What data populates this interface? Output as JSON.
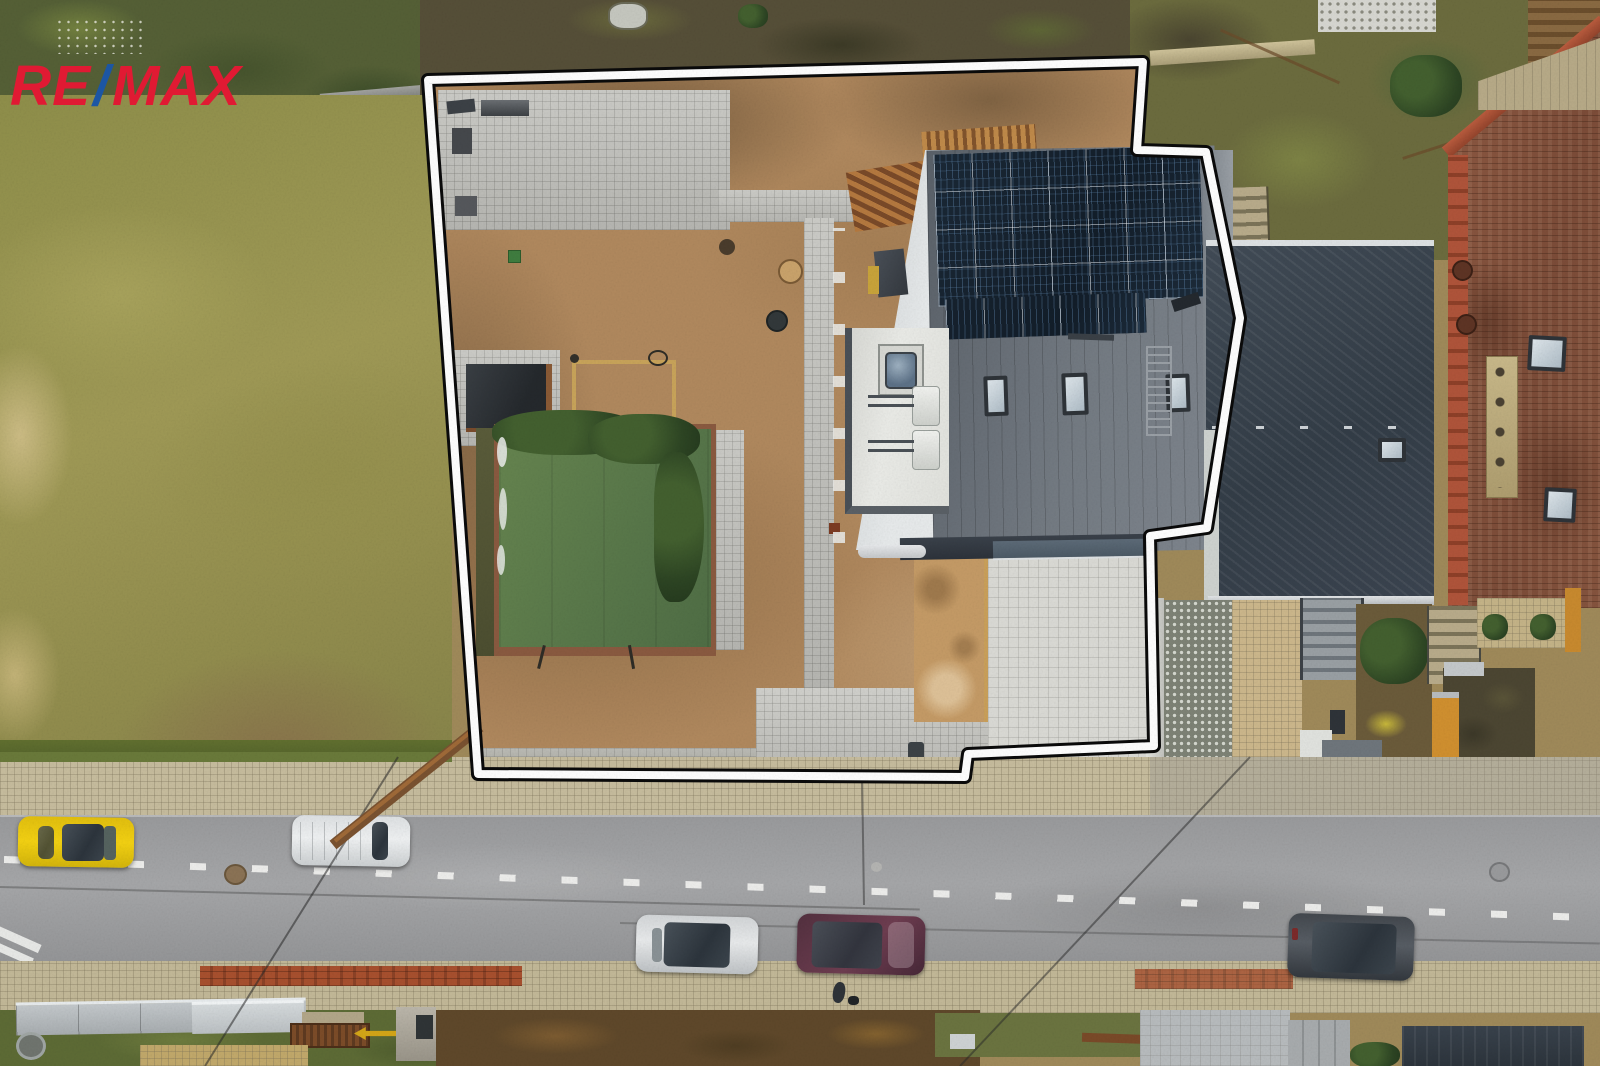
{
  "branding": {
    "logo_re": "RE",
    "logo_slash": "/",
    "logo_max": "MAX"
  },
  "palette": {
    "brand_red": "#e01a33",
    "brand_blue": "#1c56a4",
    "boundary_line_white": "#ffffff",
    "boundary_line_black": "#0a0a0a",
    "meadow_green": "#9c9850",
    "plot_sand": "#b28a5f",
    "paver_gray": "#c6c6c1",
    "driveway_light": "#dbdbd6",
    "house_roof_gray": "#6b727a",
    "solar_panel_navy": "#16222f",
    "flat_roof_white": "#e9eae6",
    "pool_cover_green": "#5d7c4b",
    "neighbor_roof_dark": "#3a444f",
    "neighbor_roof_brown": "#8a5640",
    "road_asphalt": "#9b9c9e",
    "sidewalk_tan": "#c7bd9e",
    "wall_brick_red": "#9a4a2e"
  },
  "vehicles": {
    "count": 5,
    "colors": [
      "yellow",
      "white",
      "silver",
      "maroon",
      "dark-gray"
    ]
  }
}
